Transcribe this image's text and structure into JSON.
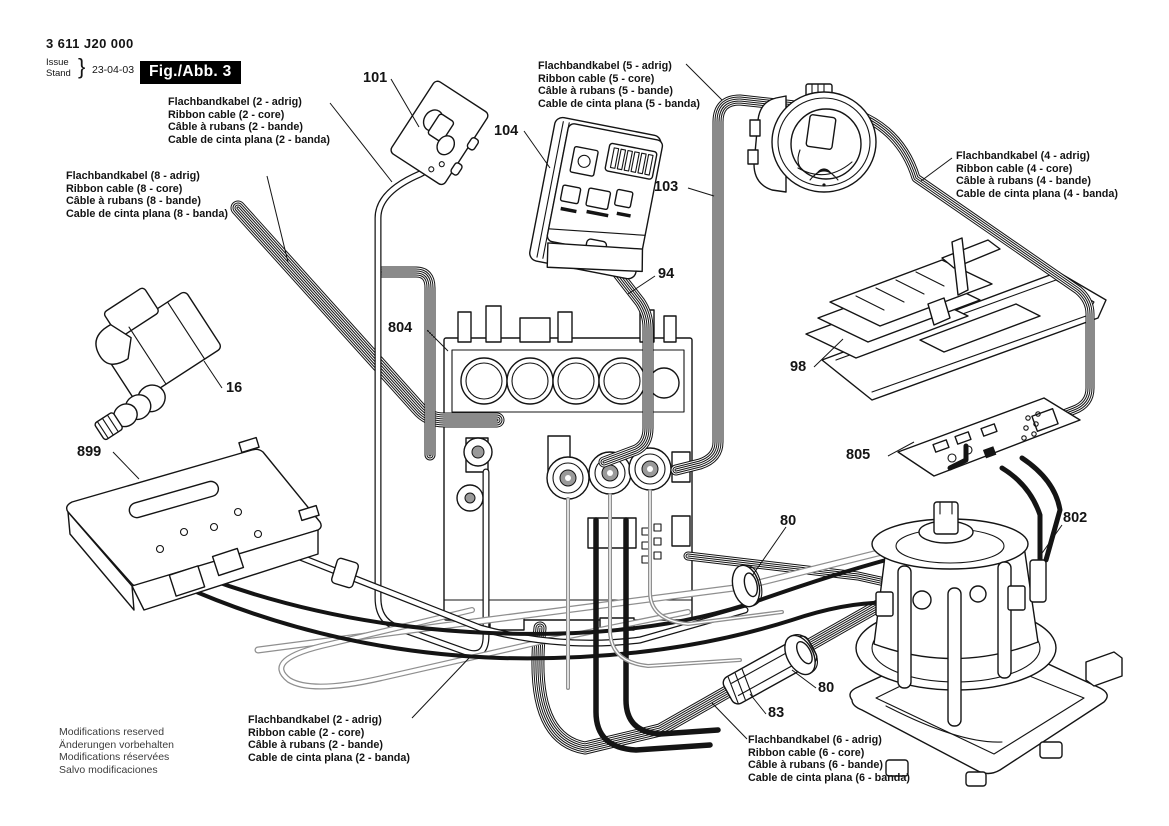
{
  "header": {
    "part_number": "3 611 J20 000",
    "issue_label": "Issue",
    "stand_label": "Stand",
    "brace": "}",
    "issue_date": "23-04-03",
    "figure_label": "Fig./Abb. 3"
  },
  "cable_labels": [
    {
      "id": "top-2core",
      "lines": [
        "Flachbandkabel (2 - adrig)",
        "Ribbon cable (2 - core)",
        "Câble à rubans (2 - bande)",
        "Cable de cinta plana (2 - banda)"
      ]
    },
    {
      "id": "top-5core",
      "lines": [
        "Flachbandkabel (5 - adrig)",
        "Ribbon cable (5 - core)",
        "Câble à rubans (5 - bande)",
        "Cable de cinta plana (5 - banda)"
      ]
    },
    {
      "id": "right-4core",
      "lines": [
        "Flachbandkabel (4 - adrig)",
        "Ribbon cable (4 - core)",
        "Câble à rubans (4 - bande)",
        "Cable de cinta plana (4 - banda)"
      ]
    },
    {
      "id": "left-8core",
      "lines": [
        "Flachbandkabel (8 - adrig)",
        "Ribbon cable (8 - core)",
        "Câble à rubans (8 - bande)",
        "Cable de cinta plana (8 - banda)"
      ]
    },
    {
      "id": "bottom-2core",
      "lines": [
        "Flachbandkabel (2 - adrig)",
        "Ribbon cable (2 - core)",
        "Câble à rubans (2 - bande)",
        "Cable de cinta plana (2 - banda)"
      ]
    },
    {
      "id": "bottom-6core",
      "lines": [
        "Flachbandkabel (6 - adrig)",
        "Ribbon cable (6 - core)",
        "Câble à rubans (6 - bande)",
        "Cable de cinta plana (6 - banda)"
      ]
    }
  ],
  "callouts": [
    {
      "text": "101"
    },
    {
      "text": "104"
    },
    {
      "text": "103"
    },
    {
      "text": "94"
    },
    {
      "text": "804"
    },
    {
      "text": "98"
    },
    {
      "text": "805"
    },
    {
      "text": "16"
    },
    {
      "text": "899"
    },
    {
      "text": "80"
    },
    {
      "text": "802"
    },
    {
      "text": "80"
    },
    {
      "text": "83"
    }
  ],
  "footer": {
    "lines": [
      "Modifications reserved",
      "Änderungen vorbehalten",
      "Modifications réservées",
      "Salvo modificaciones"
    ]
  },
  "colors": {
    "ink": "#141414",
    "gray_cable": "#8f8f8f",
    "figure_badge_bg": "#000000",
    "figure_badge_fg": "#ffffff"
  }
}
